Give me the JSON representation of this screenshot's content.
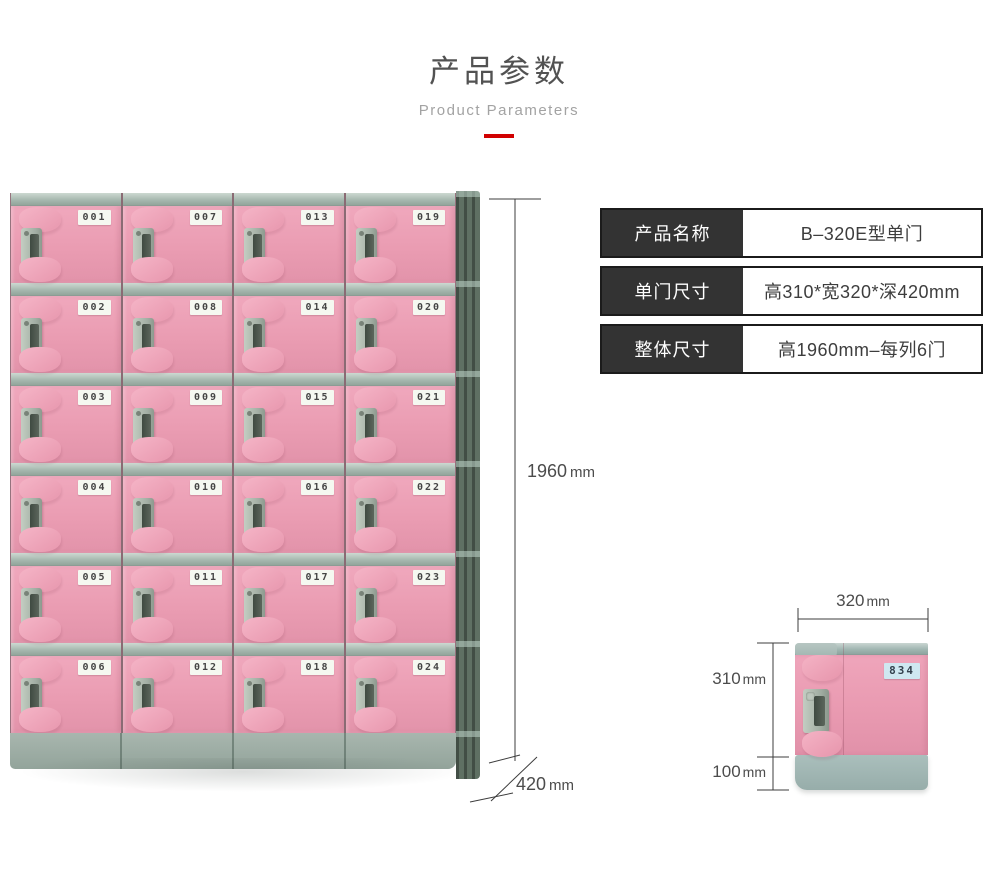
{
  "header": {
    "title": "产品参数",
    "subtitle": "Product Parameters"
  },
  "spec_table": {
    "rows": [
      {
        "label": "产品名称",
        "value": "B–320E型单门"
      },
      {
        "label": "单门尺寸",
        "value": "高310*宽320*深420mm"
      },
      {
        "label": "整体尺寸",
        "value": "高1960mm–每列6门"
      }
    ]
  },
  "main_locker": {
    "door_numbers": [
      "001",
      "002",
      "003",
      "004",
      "005",
      "006",
      "007",
      "008",
      "009",
      "010",
      "011",
      "012",
      "013",
      "014",
      "015",
      "016",
      "017",
      "018",
      "019",
      "020",
      "021",
      "022",
      "023",
      "024"
    ],
    "dimensions": {
      "overall_height": {
        "value": "1960",
        "unit": "mm"
      },
      "depth": {
        "value": "420",
        "unit": "mm"
      }
    }
  },
  "single_locker": {
    "door_number": "834",
    "dimensions": {
      "door_width": {
        "value": "320",
        "unit": "mm"
      },
      "door_height": {
        "value": "310",
        "unit": "mm"
      },
      "base_height": {
        "value": "100",
        "unit": "mm"
      }
    }
  },
  "colors": {
    "accent_red": "#d10000",
    "door_pink": "#ea9db3",
    "frame_gray_green": "#a6b8af",
    "side_panel_green": "#5f7063",
    "base_gray": "#9aaba3",
    "spec_label_bg": "#333333",
    "spec_border": "#1b1b1b",
    "single_tag_bg": "#cfe8f1"
  }
}
